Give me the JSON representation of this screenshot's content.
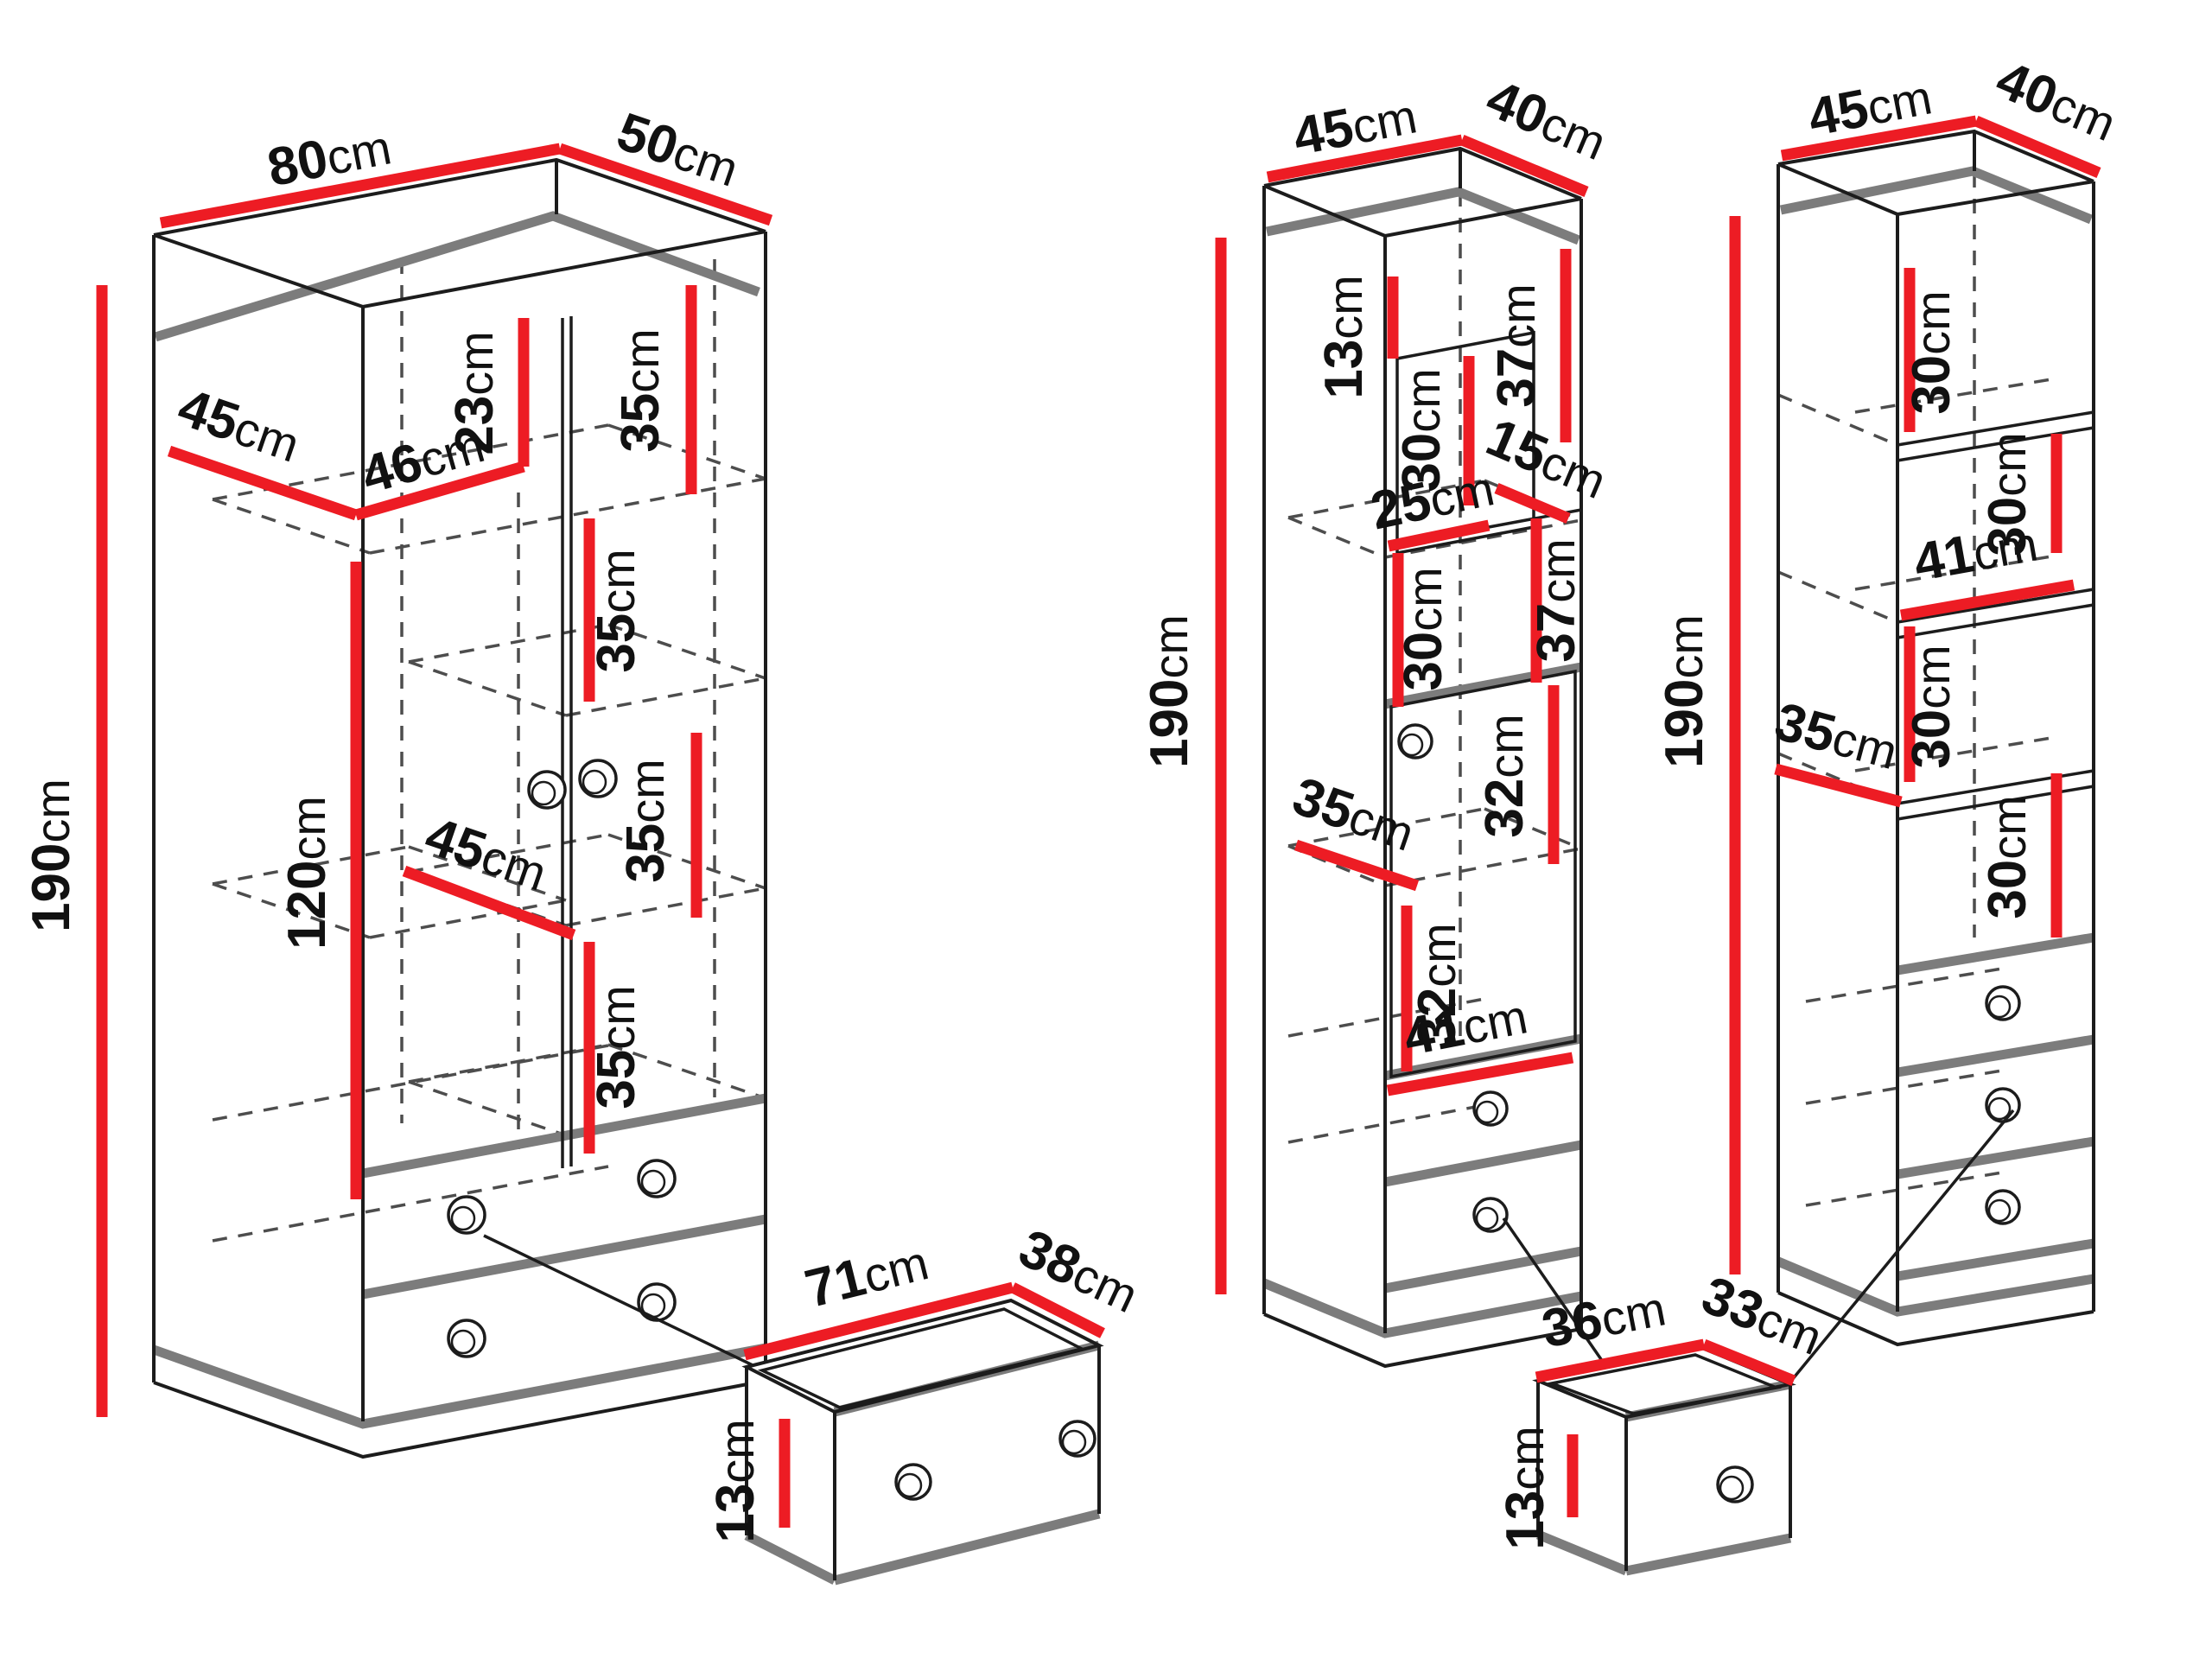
{
  "page": {
    "background": "#ffffff"
  },
  "colors": {
    "dimension_red": "#ed1c24",
    "outline_black": "#1c1c1c",
    "panel_gray": "#7c7c7c",
    "dash_gray": "#4d4d4d",
    "label_text": "#111111"
  },
  "units": {
    "wardrobe": {
      "name": "two-door wardrobe with two drawers",
      "dims": {
        "top_width": "80cm",
        "top_depth": "50cm",
        "height": "190cm",
        "top_shelf_depth": "45cm",
        "left_section_width": "46cm",
        "top_gap_height": "23cm",
        "right_gap_1": "35cm",
        "right_gap_2": "35cm",
        "right_gap_3": "35cm",
        "right_gap_4": "35cm",
        "hanging_height": "120cm",
        "middle_shelf_depth": "45cm"
      }
    },
    "tall_cabinet_left": {
      "name": "tall cabinet with niche, door and two drawers",
      "dims": {
        "top_width": "45cm",
        "top_depth": "40cm",
        "height": "190cm",
        "top_gap_height": "13cm",
        "niche_height": "30cm",
        "right_gap_1": "37cm",
        "niche_shelf_depth": "15cm",
        "niche_width": "25cm",
        "lower_niche_height": "30cm",
        "right_gap_2": "37cm",
        "shelf_depth": "35cm",
        "door_gap_right": "32cm",
        "door_gap_left": "32cm",
        "shelf_width": "41cm"
      }
    },
    "tall_cabinet_right": {
      "name": "tall open-shelf cabinet with three drawers",
      "dims": {
        "top_width": "45cm",
        "top_depth": "40cm",
        "height": "190cm",
        "gap_1": "30cm",
        "gap_2": "30cm",
        "shelf_width": "41cm",
        "gap_3": "30cm",
        "shelf_depth": "35cm",
        "gap_4": "30cm"
      }
    },
    "drawer_wide": {
      "name": "wardrobe drawer detail",
      "dims": {
        "width": "71cm",
        "depth": "38cm",
        "height": "13cm"
      }
    },
    "drawer_narrow": {
      "name": "cabinet drawer detail",
      "dims": {
        "width": "36cm",
        "depth": "33cm",
        "height": "13cm"
      }
    }
  }
}
